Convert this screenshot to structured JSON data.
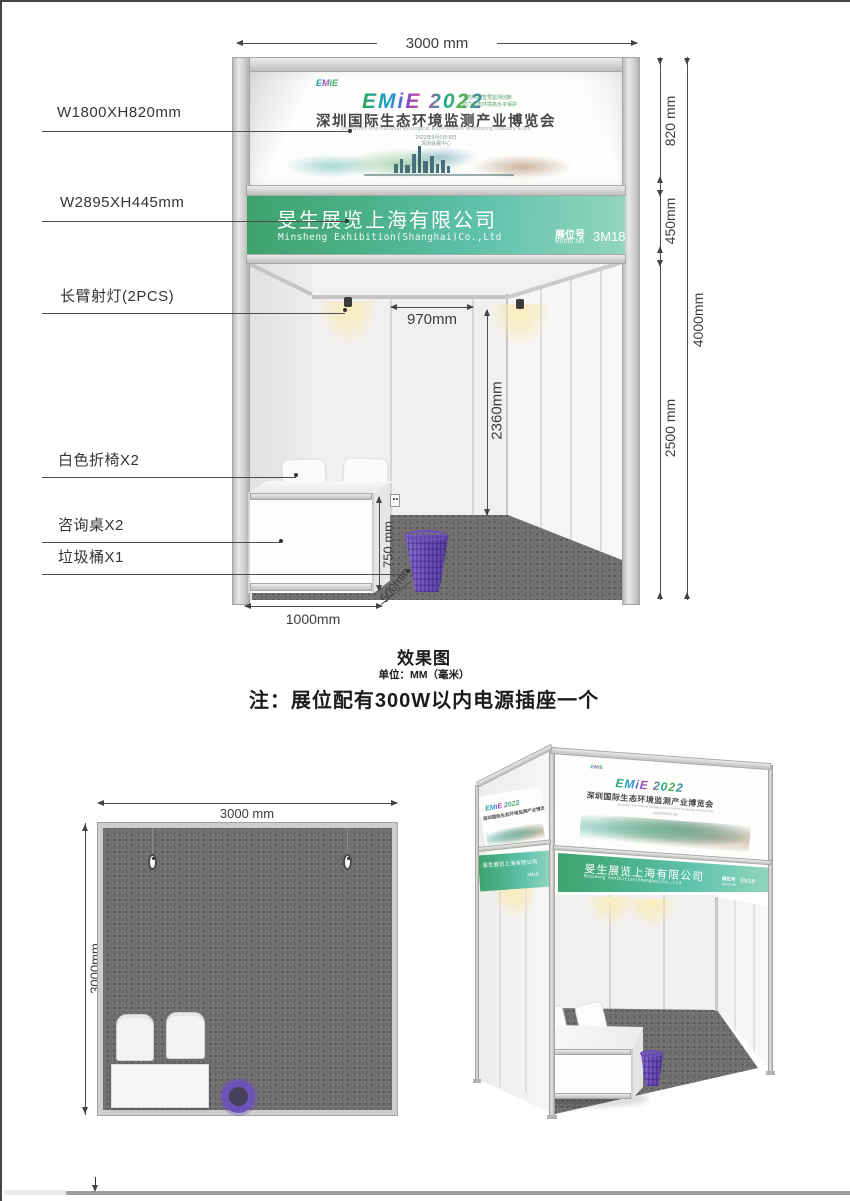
{
  "front_view": {
    "dim_width_top": "3000 mm",
    "callouts": {
      "banner_size": "W1800XH820mm",
      "fascia_size": "W2895XH445mm",
      "spotlight": "长臂射灯(2PCS)",
      "chairs": "白色折椅X2",
      "table": "咨询桌X2",
      "bin": "垃圾桶X1"
    },
    "right_dims": {
      "banner": "820 mm",
      "fascia": "450mm",
      "walls": "2500 mm",
      "total": "4000mm"
    },
    "inner_dims": {
      "panel": "970mm",
      "wall_height": "2360mm",
      "table_height": "750 mm",
      "table_width": "1000mm",
      "table_depth": "500mm"
    }
  },
  "banner": {
    "logo_small": "EMiE",
    "logo_main": "EMiE 2022",
    "tagline_line1": "生态环境智慧监测创新",
    "tagline_line2": "助力生态环境高水平保护",
    "title_cn": "深圳国际生态环境监测产业博览会",
    "title_en": "Shenzhen International Ecological Environment Monitoring Industry Expo",
    "date_line": "2022年9月6日-8日",
    "venue_line": "深圳会展中心"
  },
  "fascia": {
    "company_cn": "旻生展览上海有限公司",
    "company_en": "Minsheng Exhibition(Shanghai)Co.,Ltd",
    "booth_label_cn": "展位号",
    "booth_label_en": "Booth No",
    "booth_no": "3M18"
  },
  "notes": {
    "title": "效果图",
    "unit": "单位：MM（毫米）",
    "note": "注：展位配有300W以内电源插座一个"
  },
  "floor_plan": {
    "dim_width": "3000 mm",
    "dim_depth": "3000mm"
  },
  "colors": {
    "fascia_start": "#3da269",
    "fascia_mid": "#5fc2ab",
    "fascia_end": "#93d6bd",
    "bin_purple": "#7a5ec6",
    "carpet": "#6f6e6c",
    "frame": "#c9c9c9"
  }
}
